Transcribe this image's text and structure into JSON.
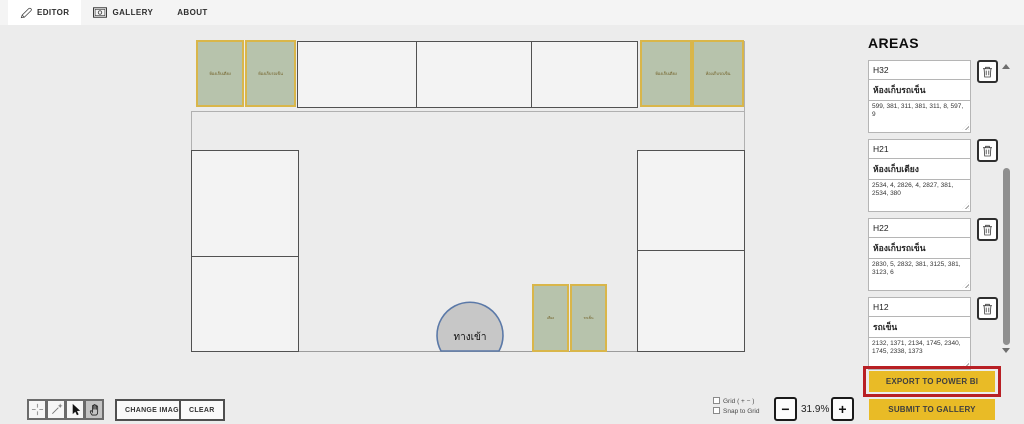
{
  "tabs": {
    "editor": "EDITOR",
    "gallery": "GALLERY",
    "about": "ABOUT"
  },
  "canvas": {
    "entrance_label": "ทางเข้า",
    "green_boxes": [
      "ห้องเก็บเตียง",
      "ห้องเก็บรถเข็น",
      "ห้องเก็บเตียง",
      "ห้องเก็บรถเข็น",
      "เตียง",
      "รถเข็น"
    ]
  },
  "areas_panel": {
    "title": "AREAS",
    "items": [
      {
        "id": "H32",
        "label": "ห้องเก็บรถเข็น",
        "coords": "599, 381, 311, 381, 311, 8, 597, 9"
      },
      {
        "id": "H21",
        "label": "ห้องเก็บเตียง",
        "coords": "2534, 4, 2826, 4, 2827, 381, 2534, 380"
      },
      {
        "id": "H22",
        "label": "ห้องเก็บรถเข็น",
        "coords": "2830, 5, 2832, 381, 3125, 381, 3123, 6"
      },
      {
        "id": "H12",
        "label": "รถเข็น",
        "coords": "2132, 1371, 2134, 1745, 2340, 1745, 2338, 1373"
      }
    ],
    "export_label": "EXPORT TO POWER BI",
    "submit_label": "SUBMIT TO GALLERY"
  },
  "toolbar": {
    "change_image_label": "CHANGE IMAGE",
    "clear_label": "CLEAR"
  },
  "view_controls": {
    "grid_label": "Grid ( + − )",
    "snap_label": "Snap to Grid",
    "zoom_level": "31.9%",
    "zoom_out": "−",
    "zoom_in": "+"
  },
  "colors": {
    "accent_yellow": "#e9bb26",
    "highlight_red": "#b81f24",
    "area_fill": "#b7c3ac",
    "area_border": "#d9b64a",
    "entrance_fill": "#c7c7c7",
    "entrance_border": "#5b79a8"
  }
}
